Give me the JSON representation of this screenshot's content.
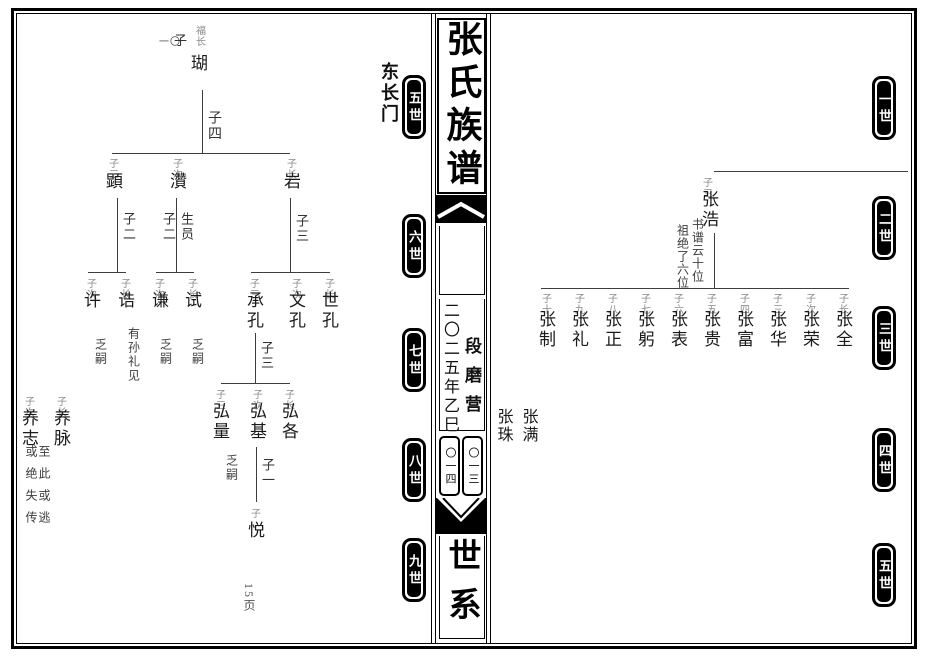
{
  "spine": {
    "title": "张氏族谱",
    "year": "二〇二五年乙巳",
    "place": "段磨营",
    "page_box_left": "〇一四",
    "page_box_right": "〇一三",
    "section": "世系"
  },
  "left_page": {
    "branch_label": "东长门",
    "page_number": "15页",
    "badges": [
      "五世",
      "六世",
      "七世",
      "八世",
      "九世"
    ],
    "ancestor": {
      "page_ref": "一〇",
      "relation": "子",
      "note": "福长",
      "name": "瑚",
      "sons_label": "子四"
    },
    "gen6": [
      {
        "label": "子三",
        "name": "顕",
        "sons_label": "子二"
      },
      {
        "label": "子次",
        "name": "灒",
        "sons_label": "子二",
        "degree": "生员"
      },
      {
        "label": "子长",
        "name": "岩",
        "sons_label": "子三"
      }
    ],
    "gen7": [
      {
        "label": "子次",
        "name": "许",
        "note": "乏嗣"
      },
      {
        "label": "子长",
        "name": "诰",
        "note": "有孙礼见"
      },
      {
        "label": "子次",
        "name": "谦",
        "note": "乏嗣"
      },
      {
        "label": "子长",
        "name": "试",
        "note": "乏嗣"
      },
      {
        "label": "子三",
        "name": "承孔",
        "sons_label": "子三"
      },
      {
        "label": "子次",
        "name": "文孔"
      },
      {
        "label": "子长",
        "name": "世孔"
      }
    ],
    "gen8": [
      {
        "label": "子三",
        "name": "弘量",
        "note": "乏嗣"
      },
      {
        "label": "子次",
        "name": "弘基",
        "sons_label": "子一"
      },
      {
        "label": "子长",
        "name": "弘各"
      },
      {
        "label": "子长",
        "name": "养脉"
      },
      {
        "label": "子次",
        "name": "养志"
      }
    ],
    "gen8_note": "至此或逃或绝失传",
    "gen9": {
      "label": "子",
      "name": "悦"
    }
  },
  "right_page": {
    "badges": [
      "一世",
      "二世",
      "三世",
      "四世",
      "五世"
    ],
    "gen2": {
      "label": "子三",
      "name": "张浩",
      "note_inner": "书谱云十位",
      "note_outer": "祖绝了六位"
    },
    "gen3": [
      {
        "label": "子十",
        "name": "张制"
      },
      {
        "label": "子九",
        "name": "张礼"
      },
      {
        "label": "子八",
        "name": "张正"
      },
      {
        "label": "子七",
        "name": "张躬"
      },
      {
        "label": "子六",
        "name": "张表"
      },
      {
        "label": "子五",
        "name": "张贵"
      },
      {
        "label": "子四",
        "name": "张富"
      },
      {
        "label": "子三",
        "name": "张华"
      },
      {
        "label": "子次",
        "name": "张荣"
      },
      {
        "label": "子长",
        "name": "张全"
      }
    ],
    "gen4": [
      {
        "name": "张满"
      },
      {
        "name": "张珠"
      }
    ]
  }
}
